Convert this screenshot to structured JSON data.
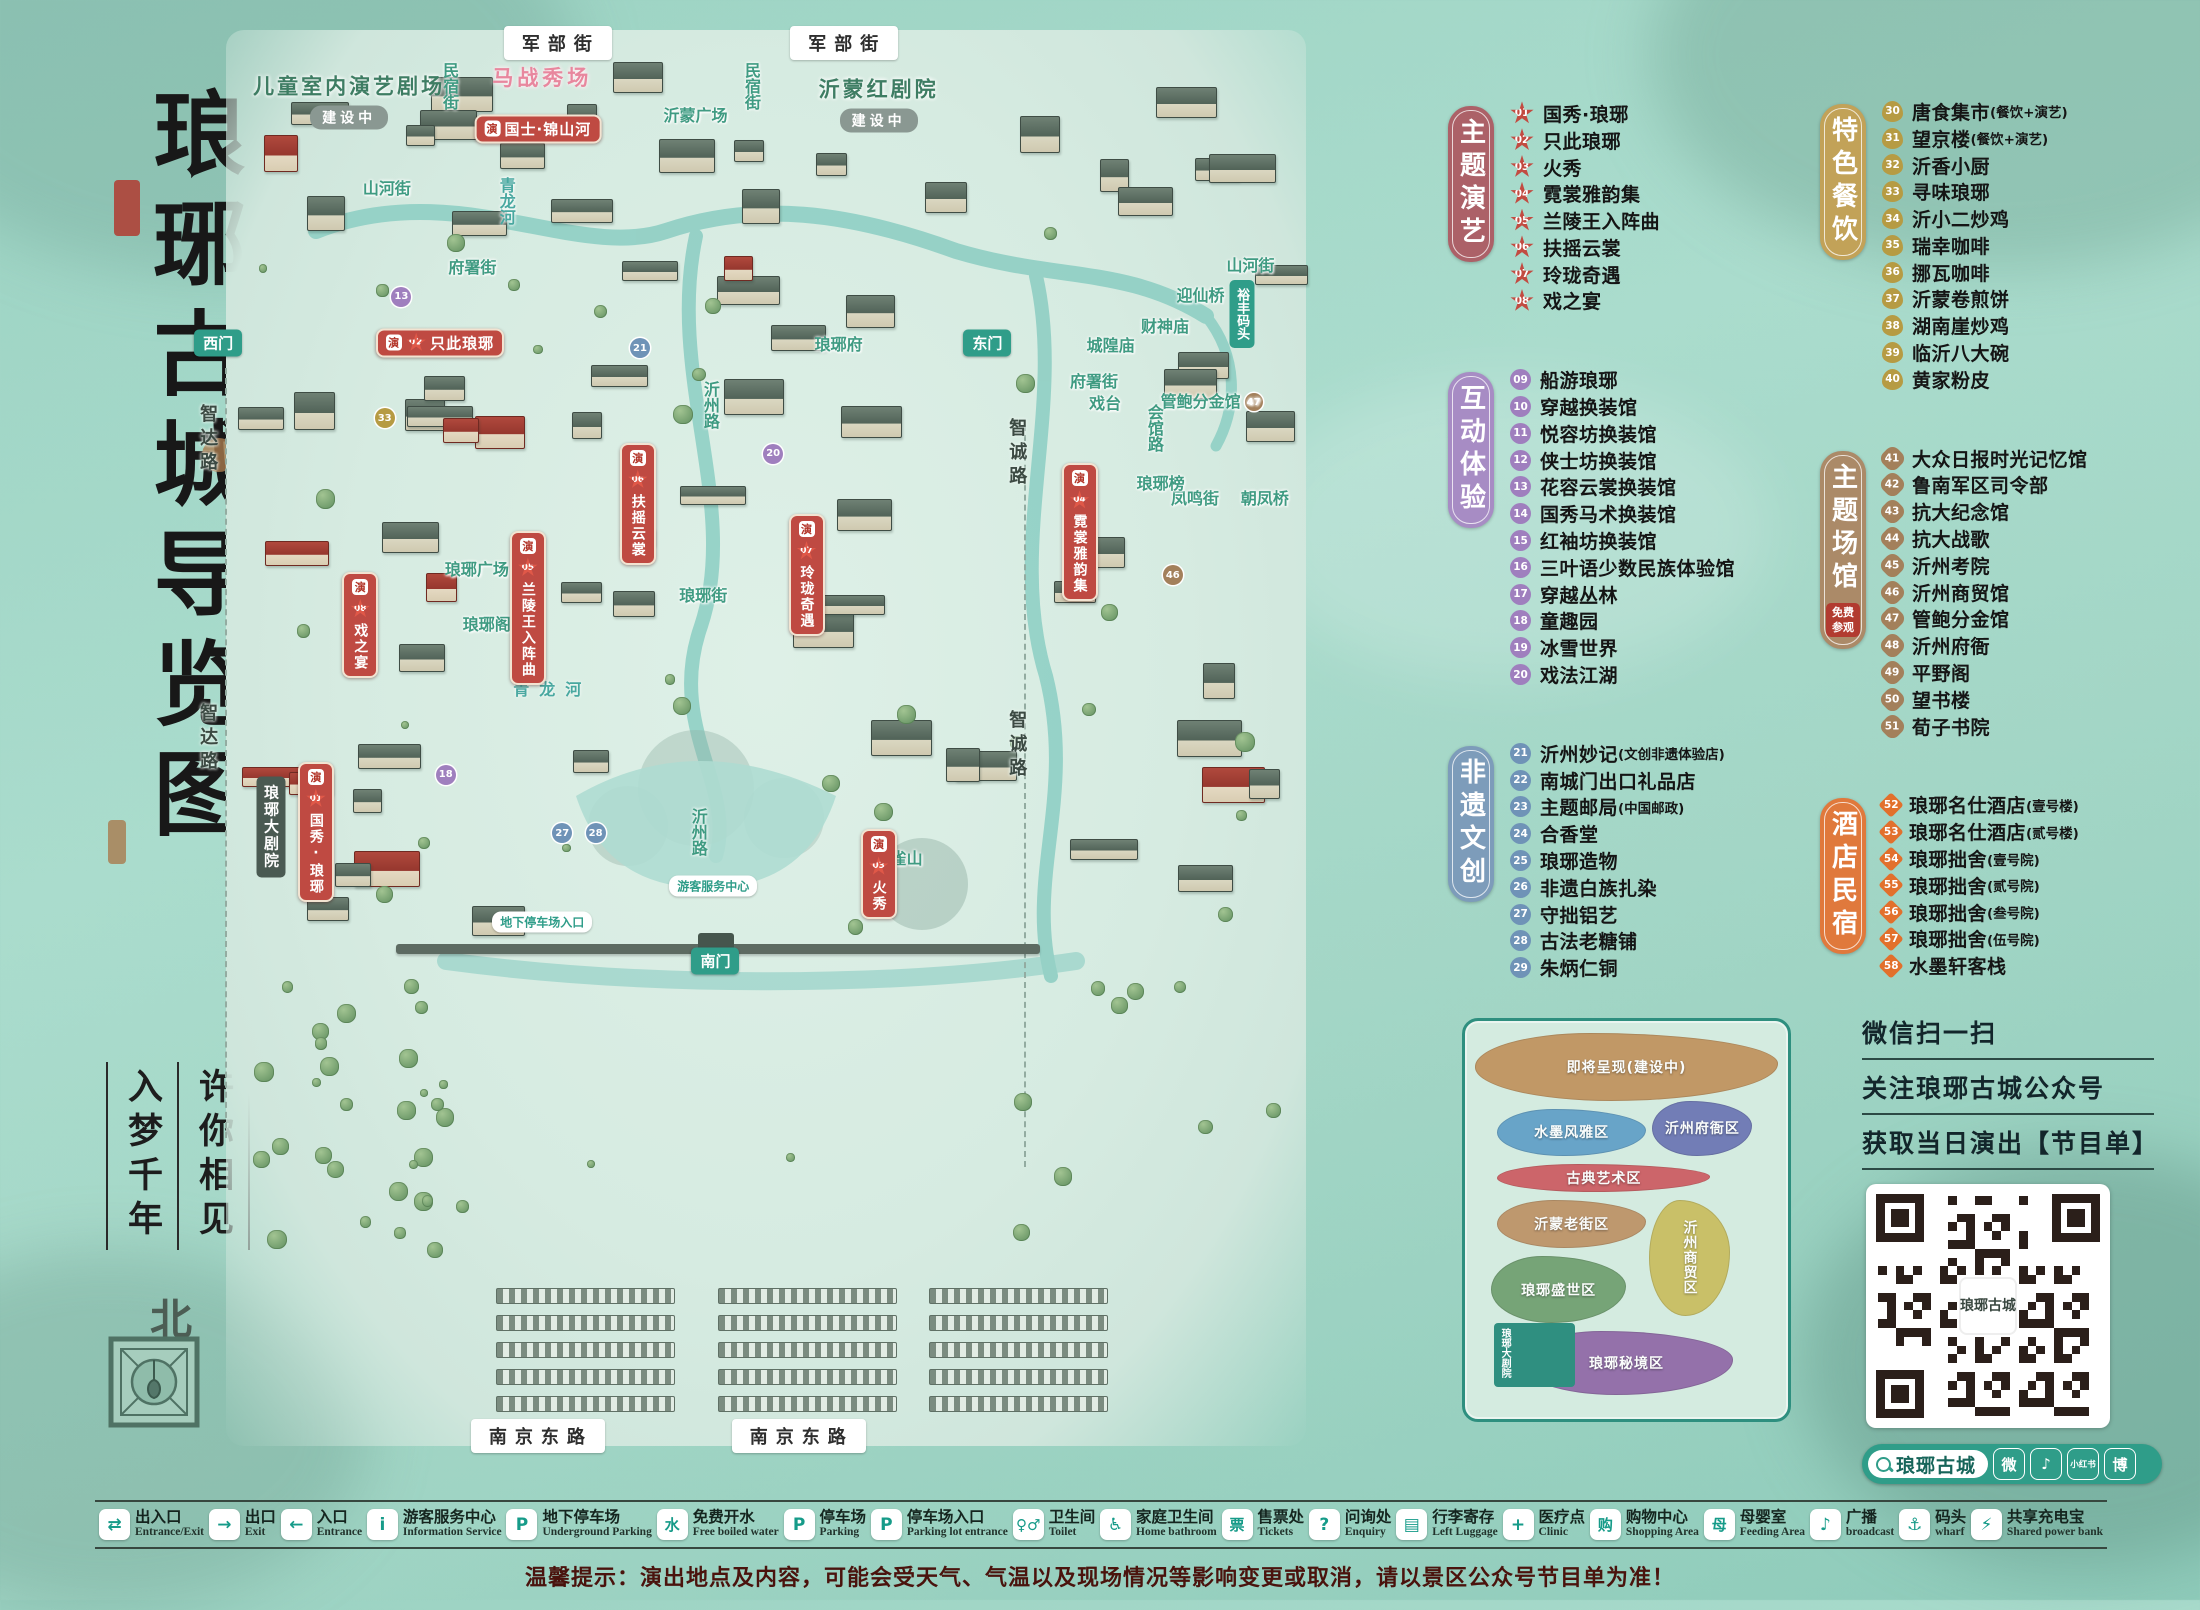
{
  "title": {
    "main": "琅琊古城导览图",
    "slogan_col_left": "入梦千年",
    "slogan_col_right": "许你相见",
    "north": "北"
  },
  "poi_columns": [
    {
      "sections": [
        {
          "label": "主题演艺",
          "tag_color": "#ac6168",
          "badge_shape": "star",
          "badge_color": "#c24b41",
          "note": "",
          "items": [
            {
              "num": "01",
              "name": "国秀·琅琊",
              "paren": ""
            },
            {
              "num": "02",
              "name": "只此琅琊",
              "paren": ""
            },
            {
              "num": "03",
              "name": "火秀",
              "paren": ""
            },
            {
              "num": "04",
              "name": "霓裳雅韵集",
              "paren": ""
            },
            {
              "num": "05",
              "name": "兰陵王入阵曲",
              "paren": ""
            },
            {
              "num": "06",
              "name": "扶摇云裳",
              "paren": ""
            },
            {
              "num": "07",
              "name": "玲珑奇遇",
              "paren": ""
            },
            {
              "num": "08",
              "name": "戏之宴",
              "paren": ""
            }
          ]
        },
        {
          "label": "互动体验",
          "tag_color": "#a78cc4",
          "badge_shape": "circle",
          "badge_color": "#9f7fbe",
          "note": "",
          "items": [
            {
              "num": "09",
              "name": "船游琅琊",
              "paren": ""
            },
            {
              "num": "10",
              "name": "穿越换装馆",
              "paren": ""
            },
            {
              "num": "11",
              "name": "悦容坊换装馆",
              "paren": ""
            },
            {
              "num": "12",
              "name": "侠士坊换装馆",
              "paren": ""
            },
            {
              "num": "13",
              "name": "花容云裳换装馆",
              "paren": ""
            },
            {
              "num": "14",
              "name": "国秀马术换装馆",
              "paren": ""
            },
            {
              "num": "15",
              "name": "红袖坊换装馆",
              "paren": ""
            },
            {
              "num": "16",
              "name": "三叶语少数民族体验馆",
              "paren": ""
            },
            {
              "num": "17",
              "name": "穿越丛林",
              "paren": ""
            },
            {
              "num": "18",
              "name": "童趣园",
              "paren": ""
            },
            {
              "num": "19",
              "name": "冰雪世界",
              "paren": ""
            },
            {
              "num": "20",
              "name": "戏法江湖",
              "paren": ""
            }
          ]
        },
        {
          "label": "非遗文创",
          "tag_color": "#7d9cba",
          "badge_shape": "circle",
          "badge_color": "#6f93b7",
          "note": "",
          "items": [
            {
              "num": "21",
              "name": "沂州妙记",
              "paren": "(文创非遗体验店)"
            },
            {
              "num": "22",
              "name": "南城门出口礼品店",
              "paren": ""
            },
            {
              "num": "23",
              "name": "主题邮局",
              "paren": "(中国邮政)"
            },
            {
              "num": "24",
              "name": "合香堂",
              "paren": ""
            },
            {
              "num": "25",
              "name": "琅琊造物",
              "paren": ""
            },
            {
              "num": "26",
              "name": "非遗白族扎染",
              "paren": ""
            },
            {
              "num": "27",
              "name": "守拙铝艺",
              "paren": ""
            },
            {
              "num": "28",
              "name": "古法老糖铺",
              "paren": ""
            },
            {
              "num": "29",
              "name": "朱炳仁铜",
              "paren": ""
            }
          ]
        }
      ]
    },
    {
      "sections": [
        {
          "label": "特色餐饮",
          "tag_color": "#c2a258",
          "badge_shape": "oval",
          "badge_color": "#b69b43",
          "note": "",
          "items": [
            {
              "num": "30",
              "name": "唐食集市",
              "paren": "(餐饮+演艺)"
            },
            {
              "num": "31",
              "name": "望京楼",
              "paren": "(餐饮+演艺)"
            },
            {
              "num": "32",
              "name": "沂香小厨",
              "paren": ""
            },
            {
              "num": "33",
              "name": "寻味琅琊",
              "paren": ""
            },
            {
              "num": "34",
              "name": "沂小二炒鸡",
              "paren": ""
            },
            {
              "num": "35",
              "name": "瑞幸咖啡",
              "paren": ""
            },
            {
              "num": "36",
              "name": "挪瓦咖啡",
              "paren": ""
            },
            {
              "num": "37",
              "name": "沂蒙卷煎饼",
              "paren": ""
            },
            {
              "num": "38",
              "name": "湖南崖炒鸡",
              "paren": ""
            },
            {
              "num": "39",
              "name": "临沂八大碗",
              "paren": ""
            },
            {
              "num": "40",
              "name": "黄家粉皮",
              "paren": ""
            }
          ]
        },
        {
          "label": "主题场馆",
          "tag_color": "#ab8a68",
          "badge_shape": "quatre",
          "badge_color": "#a3805b",
          "note": "免费参观",
          "items": [
            {
              "num": "41",
              "name": "大众日报时光记忆馆",
              "paren": ""
            },
            {
              "num": "42",
              "name": "鲁南军区司令部",
              "paren": ""
            },
            {
              "num": "43",
              "name": "抗大纪念馆",
              "paren": ""
            },
            {
              "num": "44",
              "name": "抗大战歌",
              "paren": ""
            },
            {
              "num": "45",
              "name": "沂州考院",
              "paren": ""
            },
            {
              "num": "46",
              "name": "沂州商贸馆",
              "paren": ""
            },
            {
              "num": "47",
              "name": "管鲍分金馆",
              "paren": ""
            },
            {
              "num": "48",
              "name": "沂州府衙",
              "paren": ""
            },
            {
              "num": "49",
              "name": "平野阁",
              "paren": ""
            },
            {
              "num": "50",
              "name": "望书楼",
              "paren": ""
            },
            {
              "num": "51",
              "name": "荀子书院",
              "paren": ""
            }
          ]
        },
        {
          "label": "酒店民宿",
          "tag_color": "#e0793c",
          "badge_shape": "diamond",
          "badge_color": "#e2702c",
          "note": "",
          "items": [
            {
              "num": "52",
              "name": "琅琊名仕酒店",
              "paren": "(壹号楼)"
            },
            {
              "num": "53",
              "name": "琅琊名仕酒店",
              "paren": "(贰号楼)"
            },
            {
              "num": "54",
              "name": "琅琊拙舍",
              "paren": "(壹号院)"
            },
            {
              "num": "55",
              "name": "琅琊拙舍",
              "paren": "(贰号院)"
            },
            {
              "num": "56",
              "name": "琅琊拙舍",
              "paren": "(叁号院)"
            },
            {
              "num": "57",
              "name": "琅琊拙舍",
              "paren": "(伍号院)"
            },
            {
              "num": "58",
              "name": "水墨轩客栈",
              "paren": ""
            }
          ]
        }
      ]
    }
  ],
  "map_labels": [
    {
      "kind": "road-pill",
      "text": "军部街",
      "x": 32.6,
      "y": 1.2
    },
    {
      "kind": "road-pill",
      "text": "军部街",
      "x": 58.4,
      "y": 1.2
    },
    {
      "kind": "road-pill",
      "text": "南京东路",
      "x": 30.8,
      "y": 98.9
    },
    {
      "kind": "road-pill",
      "text": "南京东路",
      "x": 54.3,
      "y": 98.9
    },
    {
      "kind": "road-vert",
      "text": "智达路",
      "x": 1.0,
      "y": 29.0
    },
    {
      "kind": "road-vert",
      "text": "智达路",
      "x": 1.0,
      "y": 50.0
    },
    {
      "kind": "road-vert",
      "text": "智诚路",
      "x": 73.9,
      "y": 30.0
    },
    {
      "kind": "road-vert",
      "text": "智诚路",
      "x": 73.9,
      "y": 50.5
    },
    {
      "kind": "street-v",
      "text": "民宿街",
      "x": 22.8,
      "y": 4.2
    },
    {
      "kind": "street-v",
      "text": "民宿街",
      "x": 50.0,
      "y": 4.2
    },
    {
      "kind": "street-h",
      "text": "山河街",
      "x": 17.2,
      "y": 11.3
    },
    {
      "kind": "street-h",
      "text": "山河街",
      "x": 95.0,
      "y": 16.7
    },
    {
      "kind": "street-h",
      "text": "府署街",
      "x": 24.9,
      "y": 16.8
    },
    {
      "kind": "street-h",
      "text": "府署街",
      "x": 80.9,
      "y": 24.8
    },
    {
      "kind": "street-v",
      "text": "会馆路",
      "x": 86.3,
      "y": 28.2
    },
    {
      "kind": "street-h",
      "text": "凤鸣街",
      "x": 90.0,
      "y": 33.0
    },
    {
      "kind": "street-h",
      "text": "琅琊街",
      "x": 45.7,
      "y": 39.8
    },
    {
      "kind": "street-v",
      "text": "沂州路",
      "x": 46.3,
      "y": 26.6
    },
    {
      "kind": "street-v",
      "text": "沂州路",
      "x": 45.2,
      "y": 56.5
    },
    {
      "kind": "river-v",
      "text": "青龙河",
      "x": 27.9,
      "y": 12.3
    },
    {
      "kind": "river-h",
      "text": "青龙河",
      "x": 32.1,
      "y": 46.4
    },
    {
      "kind": "place",
      "text": "城隍庙",
      "x": 82.4,
      "y": 22.3
    },
    {
      "kind": "place",
      "text": "财神庙",
      "x": 87.3,
      "y": 21.0
    },
    {
      "kind": "place",
      "text": "戏台",
      "x": 81.9,
      "y": 26.4
    },
    {
      "kind": "place",
      "text": "迎仙桥",
      "x": 90.5,
      "y": 18.8
    },
    {
      "kind": "gate-vert",
      "text": "裕丰码头",
      "x": 94.2,
      "y": 20.2
    },
    {
      "kind": "place",
      "text": "朝凤桥",
      "x": 96.3,
      "y": 33.0
    },
    {
      "kind": "place",
      "text": "琅琊榜",
      "x": 86.9,
      "y": 32.0
    },
    {
      "kind": "place",
      "text": "琅琊广场",
      "x": 25.3,
      "y": 38.0
    },
    {
      "kind": "place",
      "text": "琅琊阁",
      "x": 26.2,
      "y": 41.9
    },
    {
      "kind": "place",
      "text": "琅琊府",
      "x": 57.9,
      "y": 22.2
    },
    {
      "kind": "place",
      "text": "沂蒙广场",
      "x": 45.0,
      "y": 6.2
    },
    {
      "kind": "place",
      "text": "金雀山",
      "x": 63.3,
      "y": 58.3
    },
    {
      "kind": "place",
      "text": "管鲍分金馆",
      "x": 91.5,
      "y": 26.2,
      "num": "47",
      "color": "#a3805b"
    },
    {
      "kind": "gate-pill",
      "text": "西门",
      "x": 2.0,
      "y": 22.2
    },
    {
      "kind": "gate-pill",
      "text": "东门",
      "x": 71.3,
      "y": 22.2
    },
    {
      "kind": "gate-pill",
      "text": "南门",
      "x": 46.8,
      "y": 65.6
    },
    {
      "kind": "theater",
      "text": "儿童室内演艺剧场",
      "x": 13.8,
      "y": 5.2,
      "tag": "建设中"
    },
    {
      "kind": "theater",
      "text": "沂蒙红剧院",
      "x": 61.5,
      "y": 5.4,
      "tag": "建设中"
    },
    {
      "kind": "pink-title",
      "text": "马战秀场",
      "x": 31.2,
      "y": 3.6
    },
    {
      "kind": "banner-h",
      "text": "国士·锦山河",
      "x": 30.8,
      "y": 7.2
    },
    {
      "kind": "banner-h",
      "text": "只此琅琊",
      "num": "02",
      "x": 22.0,
      "y": 22.2
    },
    {
      "kind": "banner-v",
      "text": "霓裳雅韵集",
      "num": "04",
      "x": 79.6,
      "y": 35.5
    },
    {
      "kind": "banner-v",
      "text": "扶摇云裳",
      "num": "06",
      "x": 39.8,
      "y": 33.5
    },
    {
      "kind": "banner-v",
      "text": "兰陵王入阵曲",
      "num": "05",
      "x": 29.9,
      "y": 40.8
    },
    {
      "kind": "banner-v",
      "text": "玲珑奇遇",
      "num": "07",
      "x": 55.0,
      "y": 38.5
    },
    {
      "kind": "banner-v",
      "text": "戏之宴",
      "num": "08",
      "x": 14.8,
      "y": 42.0
    },
    {
      "kind": "banner-v",
      "text": "火秀",
      "num": "03",
      "x": 61.5,
      "y": 59.5
    },
    {
      "kind": "theater-v",
      "text": "琅琊大剧院",
      "x": 6.8,
      "y": 56.2
    },
    {
      "kind": "banner-v",
      "text": "国秀·琅琊",
      "num": "01",
      "x": 10.8,
      "y": 56.5
    },
    {
      "kind": "white-pill",
      "text": "地下停车场入口",
      "x": 31.2,
      "y": 62.8
    },
    {
      "kind": "white-pill",
      "text": "游客服务中心",
      "x": 46.6,
      "y": 60.3
    },
    {
      "kind": "badge",
      "num": "13",
      "x": 18.5,
      "y": 19.0,
      "color": "#9f7fbe"
    },
    {
      "kind": "badge",
      "num": "18",
      "x": 22.5,
      "y": 52.5,
      "color": "#9f7fbe"
    },
    {
      "kind": "badge",
      "num": "20",
      "x": 52.0,
      "y": 30.0,
      "color": "#9f7fbe"
    },
    {
      "kind": "badge",
      "num": "21",
      "x": 40.0,
      "y": 22.6,
      "color": "#6f93b7"
    },
    {
      "kind": "badge",
      "num": "27",
      "x": 33.0,
      "y": 56.6,
      "color": "#6f93b7"
    },
    {
      "kind": "badge",
      "num": "28",
      "x": 36.0,
      "y": 56.6,
      "color": "#6f93b7"
    },
    {
      "kind": "badge",
      "num": "33",
      "x": 17.0,
      "y": 27.5,
      "color": "#b69b43"
    },
    {
      "kind": "badge",
      "num": "46",
      "x": 88.0,
      "y": 38.5,
      "color": "#a3805b"
    }
  ],
  "inset": {
    "zones": [
      {
        "name": "即将呈现(建设中)",
        "color": "#c0915c",
        "l": 3,
        "t": 3,
        "w": 94,
        "h": 17
      },
      {
        "name": "水墨风雅区",
        "color": "#5f9ec7",
        "l": 10,
        "t": 22,
        "w": 46,
        "h": 12
      },
      {
        "name": "沂州府衙区",
        "color": "#6a74b3",
        "l": 58,
        "t": 20,
        "w": 31,
        "h": 14
      },
      {
        "name": "古典艺术区",
        "color": "#cc5a60",
        "l": 10,
        "t": 36,
        "w": 66,
        "h": 7
      },
      {
        "name": "沂蒙老街区",
        "color": "#bd9165",
        "l": 10,
        "t": 45,
        "w": 46,
        "h": 12
      },
      {
        "name": "沂州商贸区",
        "color": "#c9bd5e",
        "l": 57,
        "t": 45,
        "w": 25,
        "h": 29,
        "vertical": true
      },
      {
        "name": "琅琊盛世区",
        "color": "#6f9e6f",
        "l": 8,
        "t": 59,
        "w": 42,
        "h": 17
      },
      {
        "name": "琅琊秘境区",
        "color": "#8f67a6",
        "l": 17,
        "t": 78,
        "w": 66,
        "h": 16
      }
    ],
    "theater_label": "琅琊大剧院"
  },
  "qr_panel": {
    "lines": [
      "微信扫一扫",
      "关注琅琊古城公众号",
      "获取当日演出【节目单】"
    ],
    "qr_logo": "琅琊古城",
    "search_text": "琅琊古城",
    "social": [
      {
        "name": "wechat-icon",
        "glyph": "微",
        "small": false
      },
      {
        "name": "douyin-icon",
        "glyph": "♪",
        "small": false
      },
      {
        "name": "xiaohongshu-icon",
        "glyph": "小红书",
        "small": true
      },
      {
        "name": "weibo-icon",
        "glyph": "博",
        "small": false
      }
    ]
  },
  "legend": [
    {
      "zh": "出入口",
      "en": "Entrance/Exit",
      "glyph": "⇄",
      "cn": false
    },
    {
      "zh": "出口",
      "en": "Exit",
      "glyph": "→",
      "cn": false
    },
    {
      "zh": "入口",
      "en": "Entrance",
      "glyph": "←",
      "cn": false
    },
    {
      "zh": "游客服务中心",
      "en": "Information Service",
      "glyph": "i",
      "cn": false
    },
    {
      "zh": "地下停车场",
      "en": "Underground Parking",
      "glyph": "P",
      "cn": false
    },
    {
      "zh": "免费开水",
      "en": "Free boiled water",
      "glyph": "水",
      "cn": true
    },
    {
      "zh": "停车场",
      "en": "Parking",
      "glyph": "P",
      "cn": false
    },
    {
      "zh": "停车场入口",
      "en": "Parking lot entrance",
      "glyph": "P",
      "cn": false
    },
    {
      "zh": "卫生间",
      "en": "Toilet",
      "glyph": "♀♂",
      "cn": true
    },
    {
      "zh": "家庭卫生间",
      "en": "Home bathroom",
      "glyph": "♿",
      "cn": false
    },
    {
      "zh": "售票处",
      "en": "Tickets",
      "glyph": "票",
      "cn": true
    },
    {
      "zh": "问询处",
      "en": "Enquiry",
      "glyph": "?",
      "cn": false
    },
    {
      "zh": "行李寄存",
      "en": "Left Luggage",
      "glyph": "▤",
      "cn": false
    },
    {
      "zh": "医疗点",
      "en": "Clinic",
      "glyph": "+",
      "cn": false
    },
    {
      "zh": "购物中心",
      "en": "Shopping Area",
      "glyph": "购",
      "cn": true
    },
    {
      "zh": "母婴室",
      "en": "Feeding Area",
      "glyph": "母",
      "cn": true
    },
    {
      "zh": "广播",
      "en": "broadcast",
      "glyph": "♪",
      "cn": false
    },
    {
      "zh": "码头",
      "en": "wharf",
      "glyph": "⚓",
      "cn": false
    },
    {
      "zh": "共享充电宝",
      "en": "Shared power bank",
      "glyph": "⚡",
      "cn": false
    }
  ],
  "notice": "温馨提示：演出地点及内容，可能会受天气、气温以及现场情况等影响变更或取消，请以景区公众号节目单为准！"
}
